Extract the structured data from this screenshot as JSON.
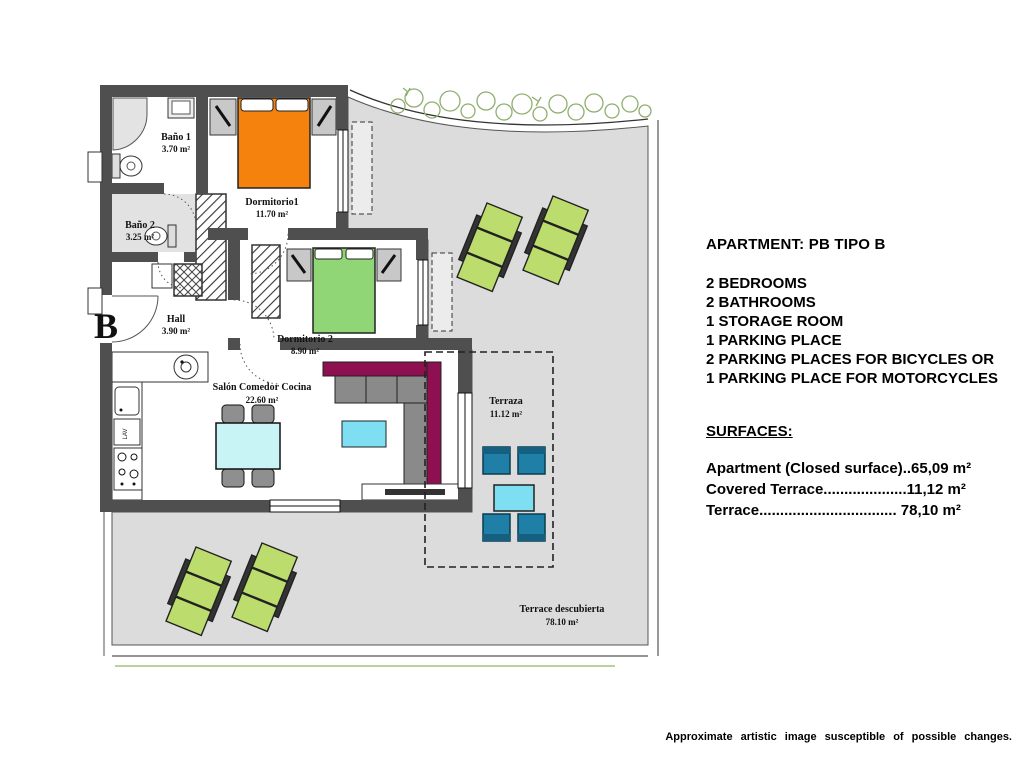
{
  "plan": {
    "block_letter": "B",
    "labels": {
      "lav": "LAV"
    },
    "rooms": {
      "bano1": {
        "name": "Baño 1",
        "area": "3.70 m²"
      },
      "bano2": {
        "name": "Baño 2",
        "area": "3.25 m²"
      },
      "dorm1": {
        "name": "Dormitorio1",
        "area": "11.70 m²"
      },
      "dorm2": {
        "name": "Dormitorio 2",
        "area": "8.90 m²"
      },
      "hall": {
        "name": "Hall",
        "area": "3.90 m²"
      },
      "salon": {
        "name": "Salón Comedor Cocina",
        "area": "22.60 m²"
      },
      "terraza": {
        "name": "Terraza",
        "area": "11.12 m²"
      },
      "open_terrace": {
        "name": "Terrace descubierta",
        "area": "78.10 m²"
      }
    },
    "colors": {
      "wall": "#4f4f4f",
      "terrace_gray": "#dcdcdc",
      "bed_orange": "#f5820c",
      "bed_green": "#90d677",
      "lounger_green": "#bcdd6e",
      "chair_teal": "#1f7fa6",
      "chair_teal_dark": "#155f80",
      "table_blue": "#7edff2",
      "table_dining": "#c9f4f6",
      "sofa_magenta": "#8e1050",
      "plant_green": "#8fae6e",
      "furn_gray": "#8f8f8f"
    }
  },
  "info_panel": {
    "title": "APARTMENT: PB TIPO B",
    "features": [
      "2 BEDROOMS",
      "2 BATHROOMS",
      "1 STORAGE ROOM",
      "1 PARKING PLACE",
      "2 PARKING PLACES FOR BICYCLES OR",
      "1 PARKING PLACE FOR MOTORCYCLES"
    ],
    "surfaces_heading": "SURFACES:",
    "surfaces": [
      "Apartment (Closed surface)..65,09 m²",
      "Covered Terrace....................11,12 m²",
      "Terrace................................. 78,10 m²"
    ]
  },
  "footer": {
    "disclaimer": "Approximate artistic image susceptible of possible changes."
  }
}
